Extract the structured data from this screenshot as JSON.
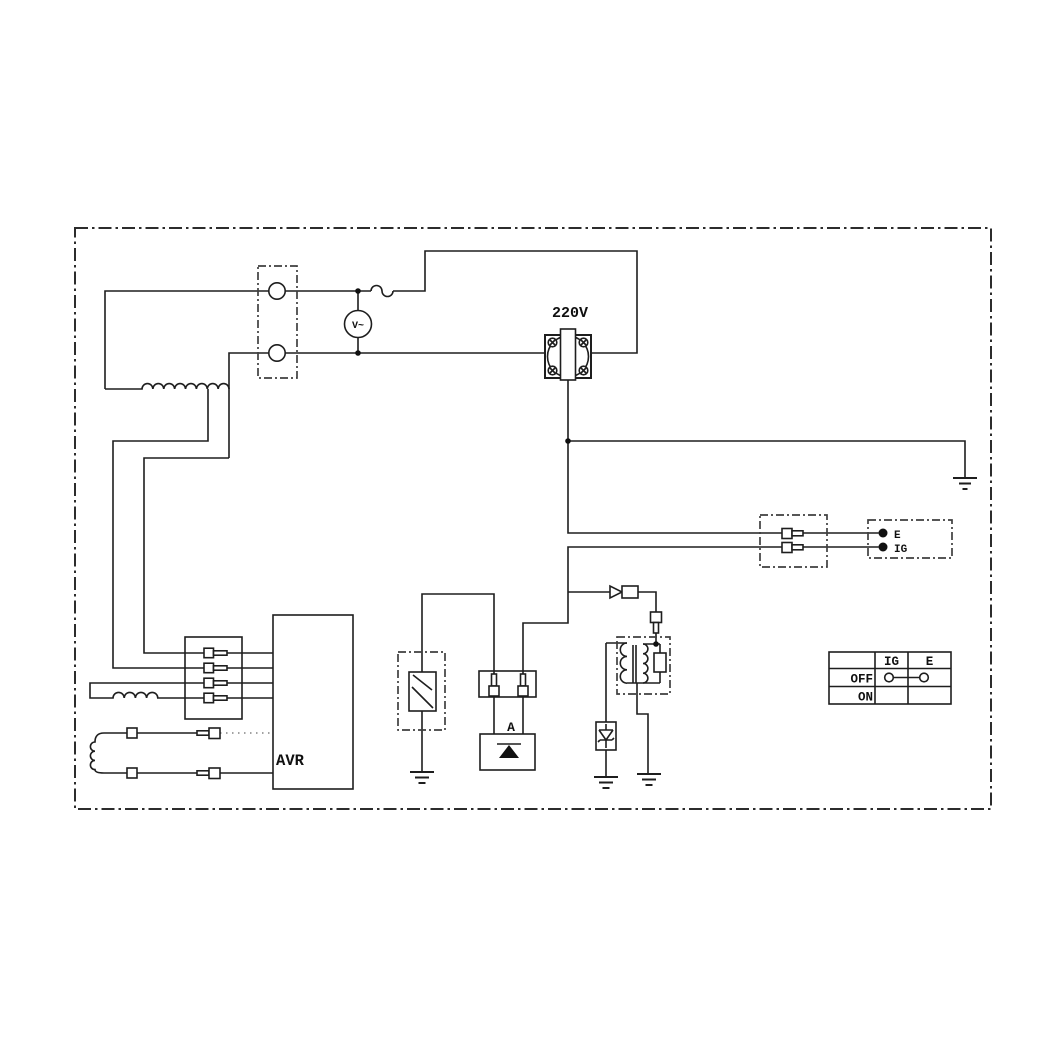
{
  "colors": {
    "background": "#ffffff",
    "line": "#1e1e1e",
    "dashed_box": "#3f3f3f"
  },
  "schematic": {
    "labels": {
      "outlet_voltage": "220V",
      "voltmeter": "V~",
      "rectifier": "A",
      "avr": "AVR"
    },
    "terminals": {
      "e": "E",
      "ig": "IG"
    },
    "table": {
      "columns": [
        "IG",
        "E"
      ],
      "rows": [
        {
          "label": "OFF",
          "connected": "IG-E"
        },
        {
          "label": "ON",
          "connected": ""
        }
      ]
    }
  }
}
